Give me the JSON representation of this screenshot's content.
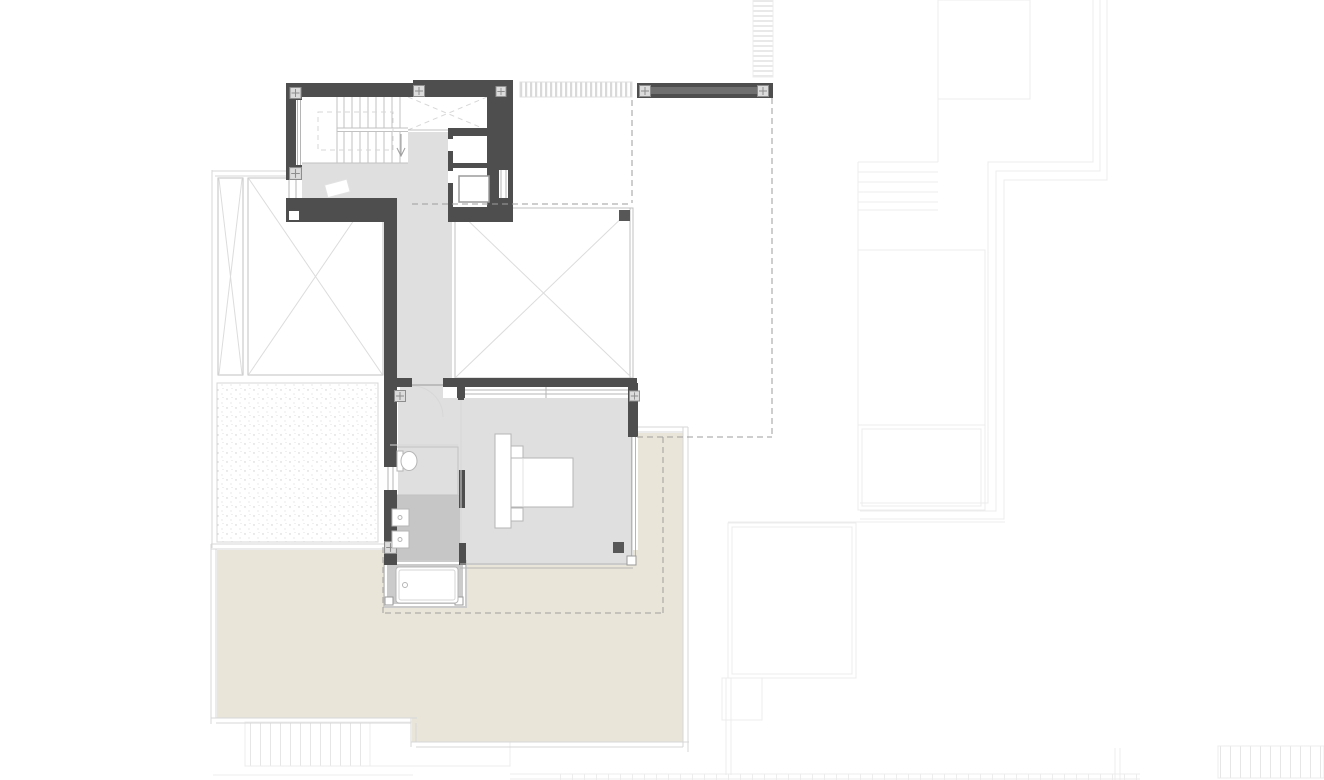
{
  "plan": {
    "type": "architectural-floor-plan",
    "text_labels": [],
    "elements": [
      "staircase",
      "stair-opening-dashed",
      "stair-direction-arrow",
      "void-over-stair",
      "hallway",
      "corridor",
      "wc-room",
      "elevator-shaft",
      "doormat",
      "void-left-with-x",
      "void-right-with-x",
      "planter-strip",
      "master-bedroom",
      "bed",
      "headboard",
      "nightstand",
      "bathroom",
      "double-sink",
      "toilet",
      "bathtub",
      "bathtub-platform",
      "gravel-roof-area",
      "terrace",
      "pergola-louvers",
      "detached-wall",
      "column-markers",
      "window-bands",
      "setback-dashed-lines",
      "ground-floor-underlay"
    ]
  },
  "colors": {
    "white": "#ffffff",
    "wall": "#4e4e4e",
    "wall_inner": "#6f6f6f",
    "dark_accent": "#575757",
    "floor": "#dfdfdf",
    "floor_wet": "#c6c6c6",
    "platform": "#cbcbcb",
    "terrace": "#e9e5d8",
    "line": "#c2c2c2",
    "line_soft": "#d7d7d7",
    "faint": "#ececec",
    "dash": "#9e9e9e",
    "column_fill": "#dcdcdc",
    "column_stroke": "#8d8d8d",
    "fixture": "#b5b5b5",
    "diag": "#dcdcdc",
    "stipple_dot": "#cdcdcd"
  }
}
